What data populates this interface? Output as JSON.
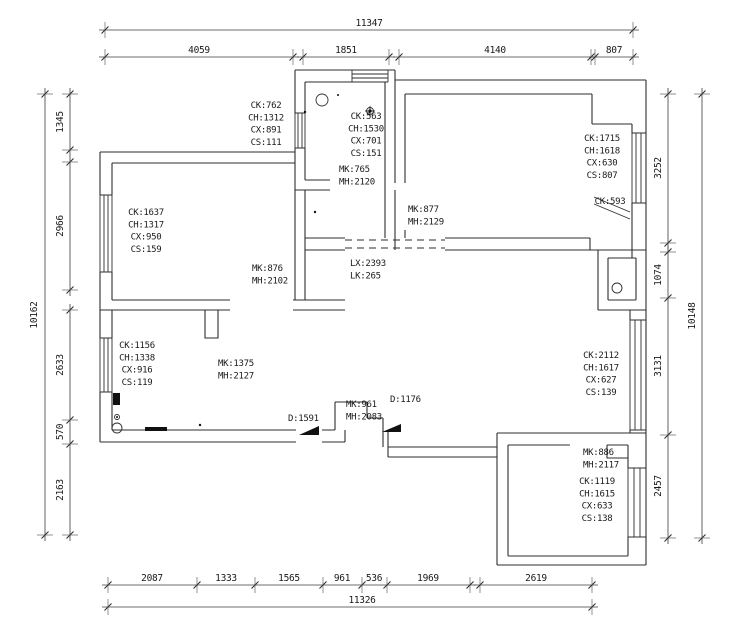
{
  "drawing": {
    "type": "floor-plan",
    "colors": {
      "background": "#ffffff",
      "line": "#2e2e2e",
      "text": "#1a1a1a"
    }
  },
  "spec_labels": [
    {
      "name": "window-spec-kitchen-left",
      "lines": [
        "CK:762",
        "CH:1312",
        "CX:891",
        "CS:111"
      ],
      "x": 266,
      "y": 108,
      "anchor": "middle"
    },
    {
      "name": "window-spec-kitchen-top",
      "lines": [
        "CK:563",
        "CH:1530",
        "CX:701",
        "CS:151"
      ],
      "x": 366,
      "y": 119,
      "anchor": "middle"
    },
    {
      "name": "door-spec-kitchen",
      "lines": [
        "MK:765",
        "MH:2120"
      ],
      "x": 339,
      "y": 172,
      "anchor": "start"
    },
    {
      "name": "window-spec-livingroom-right",
      "lines": [
        "CK:1715",
        "CH:1618",
        "CX:630",
        "CS:807"
      ],
      "x": 602,
      "y": 141,
      "anchor": "middle"
    },
    {
      "name": "window-spec-ck593",
      "lines": [
        "CK:593"
      ],
      "x": 610,
      "y": 204,
      "anchor": "middle"
    },
    {
      "name": "door-spec-livingroom",
      "lines": [
        "MK:877",
        "MH:2129"
      ],
      "x": 408,
      "y": 212,
      "anchor": "start"
    },
    {
      "name": "window-spec-bedroom1",
      "lines": [
        "CK:1637",
        "CH:1317",
        "CX:950",
        "CS:159"
      ],
      "x": 146,
      "y": 215,
      "anchor": "middle"
    },
    {
      "name": "door-spec-bedroom1",
      "lines": [
        "MK:876",
        "MH:2102"
      ],
      "x": 252,
      "y": 271,
      "anchor": "start"
    },
    {
      "name": "opening-spec-lx",
      "lines": [
        "LX:2393",
        "LK:265"
      ],
      "x": 350,
      "y": 266,
      "anchor": "start"
    },
    {
      "name": "window-spec-bedroom2",
      "lines": [
        "CK:1156",
        "CH:1338",
        "CX:916",
        "CS:119"
      ],
      "x": 137,
      "y": 348,
      "anchor": "middle"
    },
    {
      "name": "door-spec-hall",
      "lines": [
        "MK:1375",
        "MH:2127"
      ],
      "x": 218,
      "y": 366,
      "anchor": "start"
    },
    {
      "name": "door-spec-d1591",
      "lines": [
        "D:1591"
      ],
      "x": 288,
      "y": 421,
      "anchor": "start"
    },
    {
      "name": "door-spec-mk961",
      "lines": [
        "MK:961",
        "MH:2083"
      ],
      "x": 346,
      "y": 407,
      "anchor": "start"
    },
    {
      "name": "door-spec-d1176",
      "lines": [
        "D:1176"
      ],
      "x": 390,
      "y": 402,
      "anchor": "start"
    },
    {
      "name": "window-spec-right-middle",
      "lines": [
        "CK:2112",
        "CH:1617",
        "CX:627",
        "CS:139"
      ],
      "x": 601,
      "y": 358,
      "anchor": "middle"
    },
    {
      "name": "door-spec-bedroom3",
      "lines": [
        "MK:886",
        "MH:2117"
      ],
      "x": 583,
      "y": 455,
      "anchor": "start"
    },
    {
      "name": "window-spec-bedroom3",
      "lines": [
        "CK:1119",
        "CH:1615",
        "CX:633",
        "CS:138"
      ],
      "x": 597,
      "y": 484,
      "anchor": "middle"
    }
  ],
  "dim_labels": [
    {
      "name": "dim-top-total",
      "text": "11347",
      "x": 369,
      "y": 26,
      "rot": 0
    },
    {
      "name": "dim-top-1",
      "text": "4059",
      "x": 199,
      "y": 53,
      "rot": 0
    },
    {
      "name": "dim-top-2",
      "text": "1851",
      "x": 346,
      "y": 53,
      "rot": 0
    },
    {
      "name": "dim-top-3",
      "text": "4140",
      "x": 495,
      "y": 53,
      "rot": 0
    },
    {
      "name": "dim-top-4",
      "text": "807",
      "x": 614,
      "y": 53,
      "rot": 0
    },
    {
      "name": "dim-left-1",
      "text": "1345",
      "x": 63,
      "y": 122,
      "rot": -90
    },
    {
      "name": "dim-left-2",
      "text": "2966",
      "x": 63,
      "y": 226,
      "rot": -90
    },
    {
      "name": "dim-left-3",
      "text": "2633",
      "x": 63,
      "y": 365,
      "rot": -90
    },
    {
      "name": "dim-left-4",
      "text": "570",
      "x": 63,
      "y": 432,
      "rot": -90
    },
    {
      "name": "dim-left-5",
      "text": "2163",
      "x": 63,
      "y": 490,
      "rot": -90
    },
    {
      "name": "dim-left-total",
      "text": "10162",
      "x": 37,
      "y": 315,
      "rot": -90
    },
    {
      "name": "dim-right-1",
      "text": "3252",
      "x": 661,
      "y": 168,
      "rot": -90
    },
    {
      "name": "dim-right-2",
      "text": "1074",
      "x": 661,
      "y": 275,
      "rot": -90
    },
    {
      "name": "dim-right-3",
      "text": "3131",
      "x": 661,
      "y": 366,
      "rot": -90
    },
    {
      "name": "dim-right-4",
      "text": "2457",
      "x": 661,
      "y": 486,
      "rot": -90
    },
    {
      "name": "dim-right-total",
      "text": "10148",
      "x": 695,
      "y": 316,
      "rot": -90
    },
    {
      "name": "dim-bottom-1",
      "text": "2087",
      "x": 152,
      "y": 581,
      "rot": 0
    },
    {
      "name": "dim-bottom-2",
      "text": "1333",
      "x": 226,
      "y": 581,
      "rot": 0
    },
    {
      "name": "dim-bottom-3",
      "text": "1565",
      "x": 289,
      "y": 581,
      "rot": 0
    },
    {
      "name": "dim-bottom-4",
      "text": "961",
      "x": 342,
      "y": 581,
      "rot": 0
    },
    {
      "name": "dim-bottom-5",
      "text": "536",
      "x": 374,
      "y": 581,
      "rot": 0
    },
    {
      "name": "dim-bottom-6",
      "text": "1969",
      "x": 428,
      "y": 581,
      "rot": 0
    },
    {
      "name": "dim-bottom-7",
      "text": "2619",
      "x": 536,
      "y": 581,
      "rot": 0
    },
    {
      "name": "dim-bottom-total",
      "text": "11326",
      "x": 362,
      "y": 603,
      "rot": 0
    }
  ]
}
